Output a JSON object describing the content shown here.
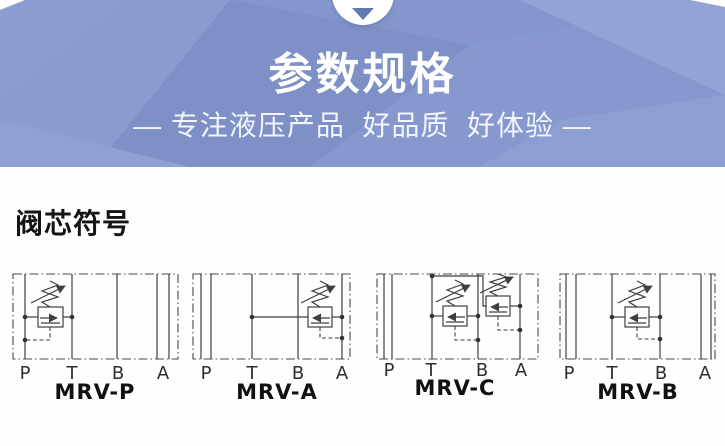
{
  "header": {
    "title": "参数规格",
    "subtitle": "— 专注液压产品  好品质  好体验 —",
    "colors": {
      "background": "#8496cb",
      "facet_light": "#96a5d6",
      "facet_dark": "#7b8dc3",
      "indicator_triangle": "#6579b2",
      "text": "#ffffff"
    }
  },
  "section": {
    "heading": "阀芯符号"
  },
  "diagrams": [
    {
      "name": "MRV-P",
      "ports": [
        "P",
        "T",
        "B",
        "A"
      ]
    },
    {
      "name": "MRV-A",
      "ports": [
        "P",
        "T",
        "B",
        "A"
      ]
    },
    {
      "name": "MRV-C",
      "ports": [
        "P",
        "T",
        "B",
        "A"
      ]
    },
    {
      "name": "MRV-B",
      "ports": [
        "P",
        "T",
        "B",
        "A"
      ]
    }
  ]
}
